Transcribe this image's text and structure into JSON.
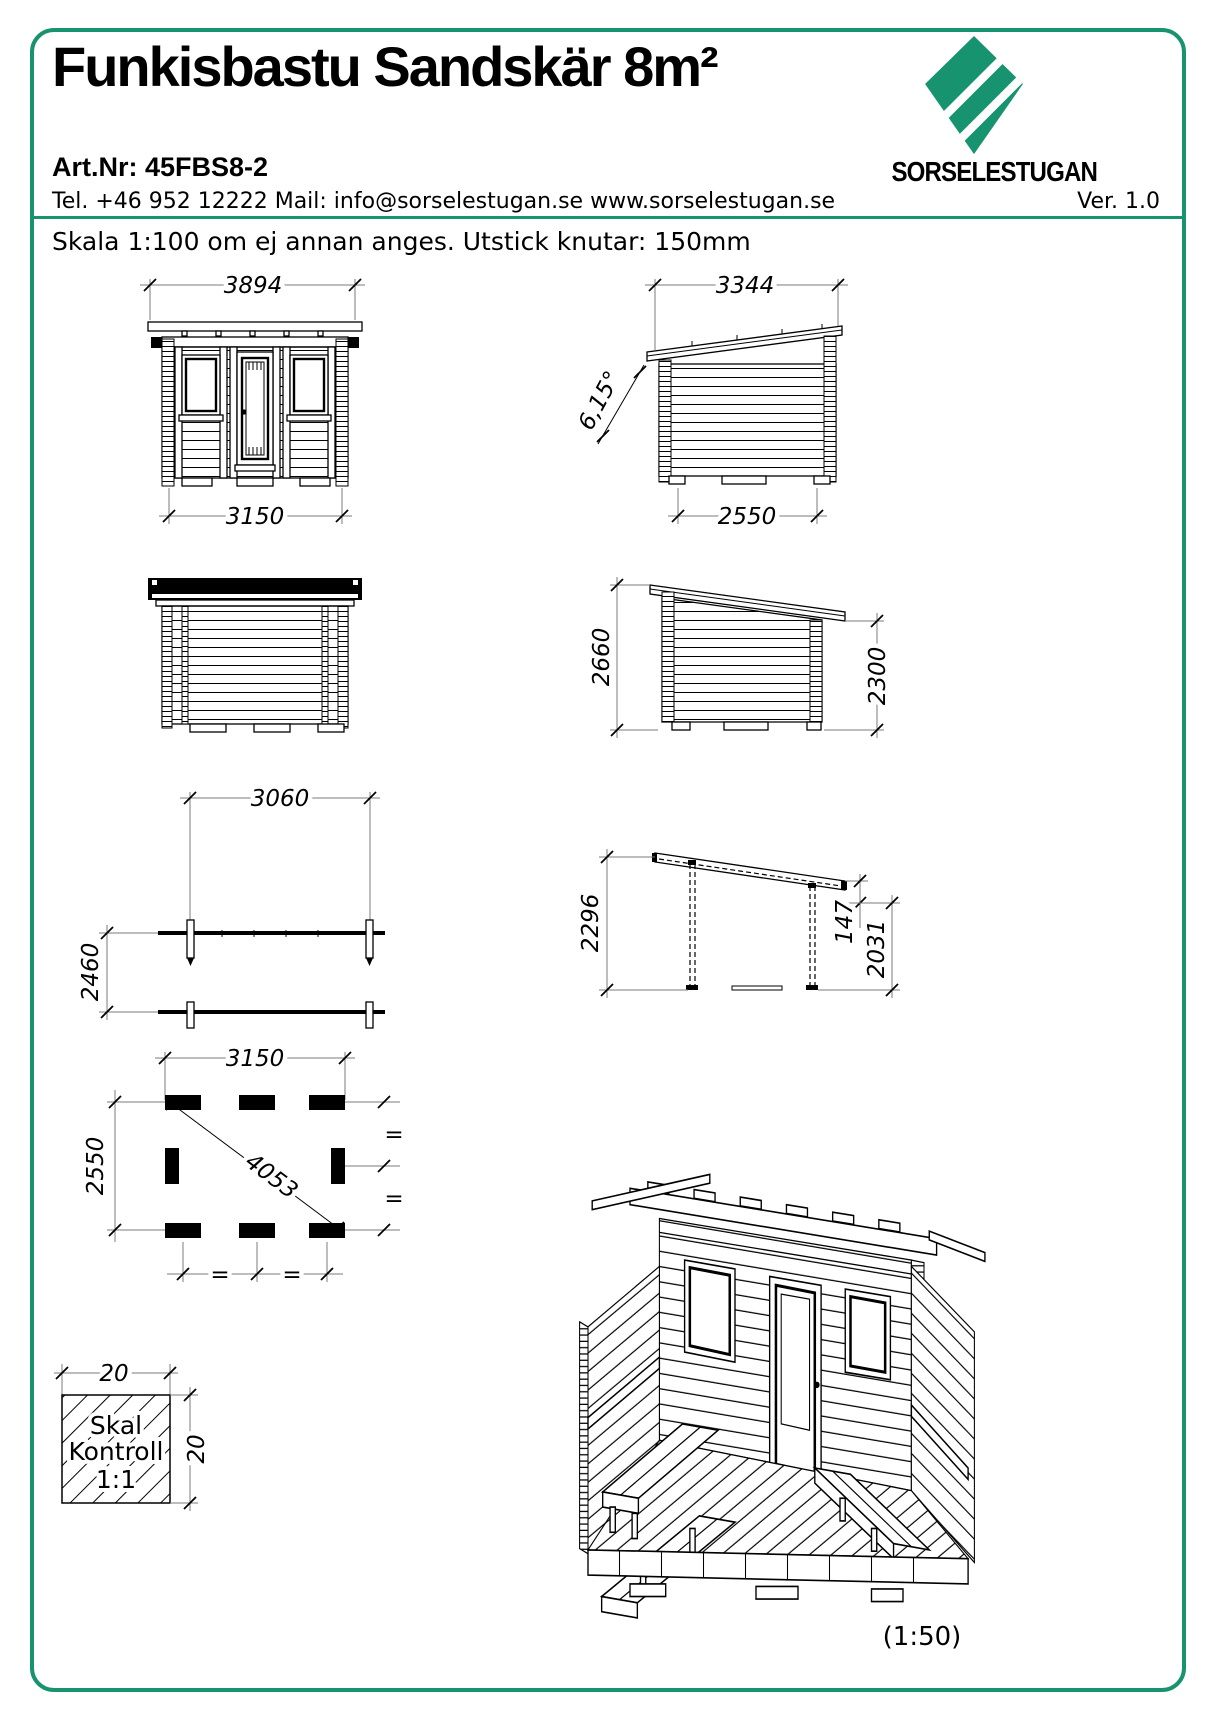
{
  "page": {
    "accent_color": "#17936f",
    "background": "#ffffff"
  },
  "header": {
    "title": "Funkisbastu Sandskär 8m²",
    "art_nr": "Art.Nr: 45FBS8-2",
    "contact": "Tel. +46 952 12222 Mail: info@sorselestugan.se  www.sorselestugan.se",
    "brand": "SORSELESTUGAN",
    "version": "Ver. 1.0",
    "scale_note": "Skala 1:100 om ej annan anges. Utstick knutar: 150mm"
  },
  "dimensions": {
    "front": {
      "roof_width": "3894",
      "base_width": "3150"
    },
    "side_right": {
      "roof_depth": "3344",
      "angle": "6,15°",
      "base_depth": "2550"
    },
    "side_left": {
      "height_high": "2660",
      "height_low": "2300"
    },
    "plan": {
      "inner_width": "3060",
      "inner_depth": "2460"
    },
    "frame": {
      "back_height": "2296",
      "beam": "147",
      "front_height": "2031"
    },
    "foundation": {
      "width": "3150",
      "depth": "2550",
      "diagonal": "4053",
      "equal": "="
    },
    "scale_check": {
      "w": "20",
      "h": "20",
      "line1": "Skal",
      "line2": "Kontroll",
      "line3": "1:1"
    },
    "iso": {
      "scale": "(1:50)"
    }
  }
}
